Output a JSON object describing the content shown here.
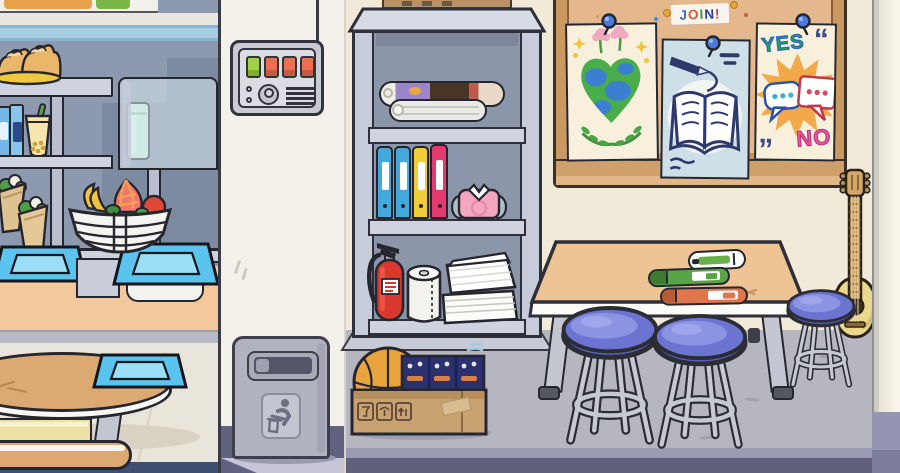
{
  "scene": {
    "description": "Cartoon school interior: cafeteria counter on left, supply cabinet in middle, classroom with bulletin board, craft table, stools and guitar on right"
  },
  "board": {
    "join": {
      "text": "JOIN!",
      "letters": [
        "J",
        "O",
        "I",
        "N",
        "!"
      ],
      "letter_colors": [
        "#3a66c8",
        "#e05432",
        "#3f9e48",
        "#2a3f8e",
        "#d43a3a"
      ]
    },
    "posters": [
      {
        "name": "earth-heart-flowers-poster"
      },
      {
        "name": "open-book-and-pen-poster"
      },
      {
        "name": "yes-no-speech-bubbles-poster",
        "yes_label": "YES",
        "no_label": "NO"
      }
    ]
  },
  "icons": {
    "trash_sticker": "person-dropping-litter",
    "box_marks": [
      "fragile-glass",
      "keep-dry-umbrella",
      "this-way-up-arrows"
    ]
  },
  "objects": {
    "left_room": [
      "bread loaves on plate",
      "canned drinks",
      "bubble tea",
      "green jar",
      "wrap sandwiches",
      "fruit bowl",
      "serving trays",
      "oval table with tray",
      "benches"
    ],
    "column": [
      "control panel with buttons",
      "trash can"
    ],
    "cabinet": [
      "rolled posters",
      "binders",
      "folded shirt",
      "fire extinguisher",
      "paper towel roll",
      "paper stacks"
    ],
    "floor_box": [
      "basketball",
      "board game boxes"
    ],
    "classroom": [
      "craft table",
      "markers",
      "three blue stools",
      "acoustic guitar"
    ]
  },
  "colors": {
    "left_wall": "#8c99ae",
    "blue_stripe": "#a9cde0",
    "white_wall": "#f4f1ea",
    "cream_wall": "#f1ead9",
    "floor_gray": "#b6b6c1",
    "baseboard_dark": "#5f617c",
    "counter_orange": "#f3c89c",
    "table_wood": "#eec494",
    "stool_blue": "#6b74d0",
    "tray_blue": "#5ac4ee",
    "cork": "#e4b88c",
    "frame_wood": "#c9995f",
    "binder_blue": "#45a8dc",
    "binder_yellow": "#f0cd3a",
    "binder_pink": "#e53a6e",
    "extinguisher_red": "#d9382e",
    "basketball_orange": "#e9a43d",
    "cardboard": "#c9a271",
    "button_green": "#9fd23e",
    "button_red": "#ee6e52"
  }
}
